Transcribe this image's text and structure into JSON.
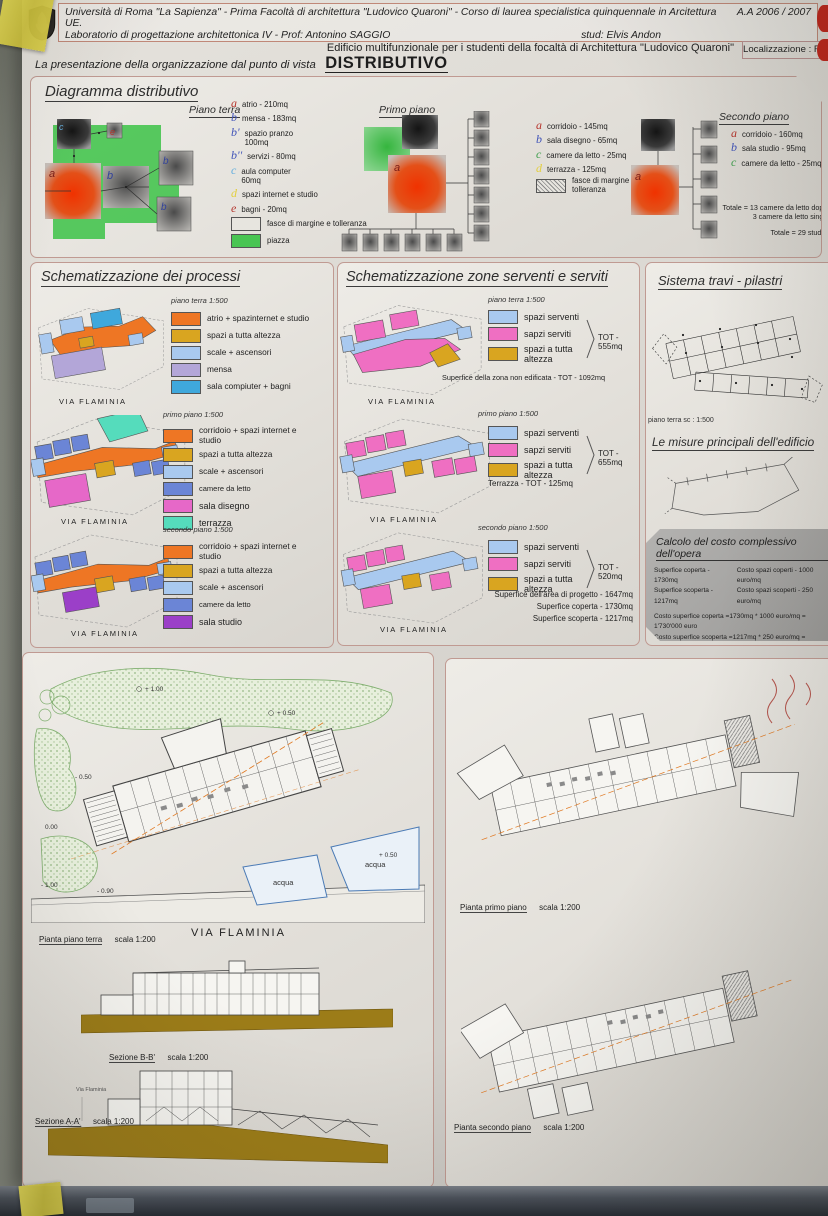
{
  "header": {
    "line1": "Università di Roma \"La Sapienza\" - Prima Facoltà di architettura \"Ludovico Quaroni\" - Corso di laurea specialistica quinquennale in Arcitettura UE.",
    "year": "A.A 2006 / 2007",
    "line2": "Laboratorio di progettazione architettonica IV - Prof:  Antonino SAGGIO",
    "student": "stud: Elvis Andon",
    "subtitle": "Edificio multifunzionale per i studenti della focaltà di Architettura \"Ludovico Quaroni\"",
    "location": "Localizzazione : Roma",
    "title_prefix": "La presentazione della organizzazione dal punto di vista",
    "title_word": "DISTRIBUTIVO"
  },
  "diagramma": {
    "title": "Diagramma distributivo",
    "piano_terra": {
      "name": "Piano terra",
      "legend": [
        {
          "key": "a",
          "kc": "#b5342c",
          "label": "atrio - 210mq"
        },
        {
          "key": "b",
          "kc": "#4053b8",
          "label": "mensa - 183mq"
        },
        {
          "key": "b'",
          "kc": "#4053b8",
          "label": "spazio pranzo 100mq"
        },
        {
          "key": "b''",
          "kc": "#4053b8",
          "label": "servizi - 80mq"
        },
        {
          "key": "c",
          "kc": "#64aede",
          "label": "aula computer 60mq"
        },
        {
          "key": "d",
          "kc": "#e3cf3e",
          "label": "spazi internet e studio"
        },
        {
          "key": "e",
          "kc": "#b5342c",
          "label": "bagni - 20mq"
        }
      ],
      "swatches": [
        {
          "type": "outline",
          "label": "fasce di margine e tolleranza"
        },
        {
          "type": "green",
          "color": "#49c553",
          "label": "piazza"
        }
      ]
    },
    "primo_piano": {
      "name": "Primo piano",
      "legend": [
        {
          "key": "a",
          "kc": "#b5342c",
          "label": "corridoio - 145mq"
        },
        {
          "key": "b",
          "kc": "#4053b8",
          "label": "sala disegno - 65mq"
        },
        {
          "key": "c",
          "kc": "#3f9e4d",
          "label": "camere da letto - 25mq"
        },
        {
          "key": "d",
          "kc": "#e3cf3e",
          "label": "terrazza - 125mq"
        }
      ],
      "swatches": [
        {
          "type": "hatch",
          "label": "fasce di margine e tolleranza"
        }
      ]
    },
    "secondo_piano": {
      "name": "Secondo piano",
      "legend": [
        {
          "key": "a",
          "kc": "#b5342c",
          "label": "corridoio - 160mq"
        },
        {
          "key": "b",
          "kc": "#4053b8",
          "label": "sala studio - 95mq"
        },
        {
          "key": "c",
          "kc": "#3f9e4d",
          "label": "camere da letto - 25mq"
        }
      ],
      "totals": [
        "Totale = 13 camere da letto doppie",
        "3 camere da letto singole",
        "Totale = 29 studenti"
      ]
    }
  },
  "processi": {
    "title": "Schematizzazione dei processi",
    "groups": [
      {
        "caption": "piano terra 1:500",
        "street": "VIA FLAMINIA",
        "items": [
          {
            "color": "#ee7624",
            "label": "atrio + spazinternet e studio"
          },
          {
            "color": "#d9a520",
            "label": "spazi a tutta altezza"
          },
          {
            "color": "#a9c9ef",
            "label": "scale + ascensori"
          },
          {
            "color": "#b3a6d8",
            "label": "mensa"
          },
          {
            "color": "#3fa8dc",
            "label": "sala compiuter + bagni"
          }
        ]
      },
      {
        "caption": "primo piano 1:500",
        "street": "VIA FLAMINIA",
        "items": [
          {
            "color": "#ee7624",
            "label": "corridoio + spazi internet e studio"
          },
          {
            "color": "#d9a520",
            "label": "spazi a tutta altezza"
          },
          {
            "color": "#a9c9ef",
            "label": "scale + ascensori"
          },
          {
            "color": "#6b85d6",
            "label": "camere da letto"
          },
          {
            "color": "#e668c8",
            "label": "sala disegno"
          },
          {
            "color": "#55dcbc",
            "label": "terrazza"
          }
        ]
      },
      {
        "caption": "secondo piano 1:500",
        "street": "VIA FLAMINIA",
        "items": [
          {
            "color": "#ee7624",
            "label": "corridoio + spazi internet e studio"
          },
          {
            "color": "#d9a520",
            "label": "spazi a tutta altezza"
          },
          {
            "color": "#a9c9ef",
            "label": "scale + ascensori"
          },
          {
            "color": "#6b85d6",
            "label": "camere da letto"
          },
          {
            "color": "#9b3fc8",
            "label": "sala studio"
          }
        ]
      }
    ]
  },
  "zone": {
    "title": "Schematizzazione zone serventi e serviti",
    "groups": [
      {
        "caption": "piano terra 1:500",
        "street": "VIA FLAMINIA",
        "tot": "TOT - 555mq",
        "note": "Superfice della zona non edificata - TOT - 1092mq",
        "items": [
          {
            "color": "#a9c9ef",
            "label": "spazi serventi"
          },
          {
            "color": "#ef6fc2",
            "label": "sapzi serviti"
          },
          {
            "color": "#d9a520",
            "label": "spazi a tutta altezza"
          }
        ]
      },
      {
        "caption": "primo piano 1:500",
        "street": "VIA FLAMINIA",
        "tot": "TOT - 655mq",
        "note": "Terrazza - TOT - 125mq",
        "items": [
          {
            "color": "#a9c9ef",
            "label": "spazi serventi"
          },
          {
            "color": "#ef6fc2",
            "label": "sapzi serviti"
          },
          {
            "color": "#d9a520",
            "label": "spazi a tutta altezza"
          }
        ]
      },
      {
        "caption": "secondo piano 1:500",
        "street": "VIA FLAMINIA",
        "tot": "TOT - 520mq",
        "notes": [
          "Superfice dell'area di progetto - 1647mq",
          "Superfice coperta - 1730mq",
          "Superfice scoperta - 1217mq"
        ],
        "items": [
          {
            "color": "#a9c9ef",
            "label": "spazi serventi"
          },
          {
            "color": "#ef6fc2",
            "label": "sapzi serviti"
          },
          {
            "color": "#d9a520",
            "label": "spazi a tutta altezza"
          }
        ]
      }
    ]
  },
  "struttura": {
    "title": "Sistema travi - pilastri",
    "caption": "piano terra  sc : 1:500",
    "misure_title": "Le misure principali dell'edificio"
  },
  "costo": {
    "title": "Calcolo del costo complessivo dell'opera",
    "surf": [
      "Superfice coperta - 1730mq",
      "Superfice scoperta - 1217mq"
    ],
    "costs": [
      "Costo spazi coperti - 1000 euro/mq",
      "Costo spazi scoperti - 250 euro/mq"
    ],
    "rows": [
      "Costo superfice coperta =1730mq * 1000 euro/mq = 1'730'000 euro",
      "Costo superfice scoperta =1217mq * 250 euro/mq = 304'250 euro"
    ],
    "total": "COSTO TOTALE = 2'034'250 euro"
  },
  "plans": {
    "street": "VIA FLAMINIA",
    "acqua": "acqua",
    "elev": [
      "+ 1.00",
      "+ 0.50",
      "- 0.50",
      "0.00",
      "- 0.90",
      "- 1.00",
      "+ 0.50"
    ],
    "terra_label": "Pianta piano terra",
    "terra_scale": "scala 1:200",
    "sezb_label": "Sezione B-B'",
    "sezb_scale": "scala 1:200",
    "seza_label": "Sezione A-A'",
    "seza_scale": "scala 1:200",
    "primo_label": "Pianta primo piano",
    "primo_scale": "scala 1:200",
    "secondo_label": "Pianta secondo piano",
    "secondo_scale": "scala 1:200"
  }
}
